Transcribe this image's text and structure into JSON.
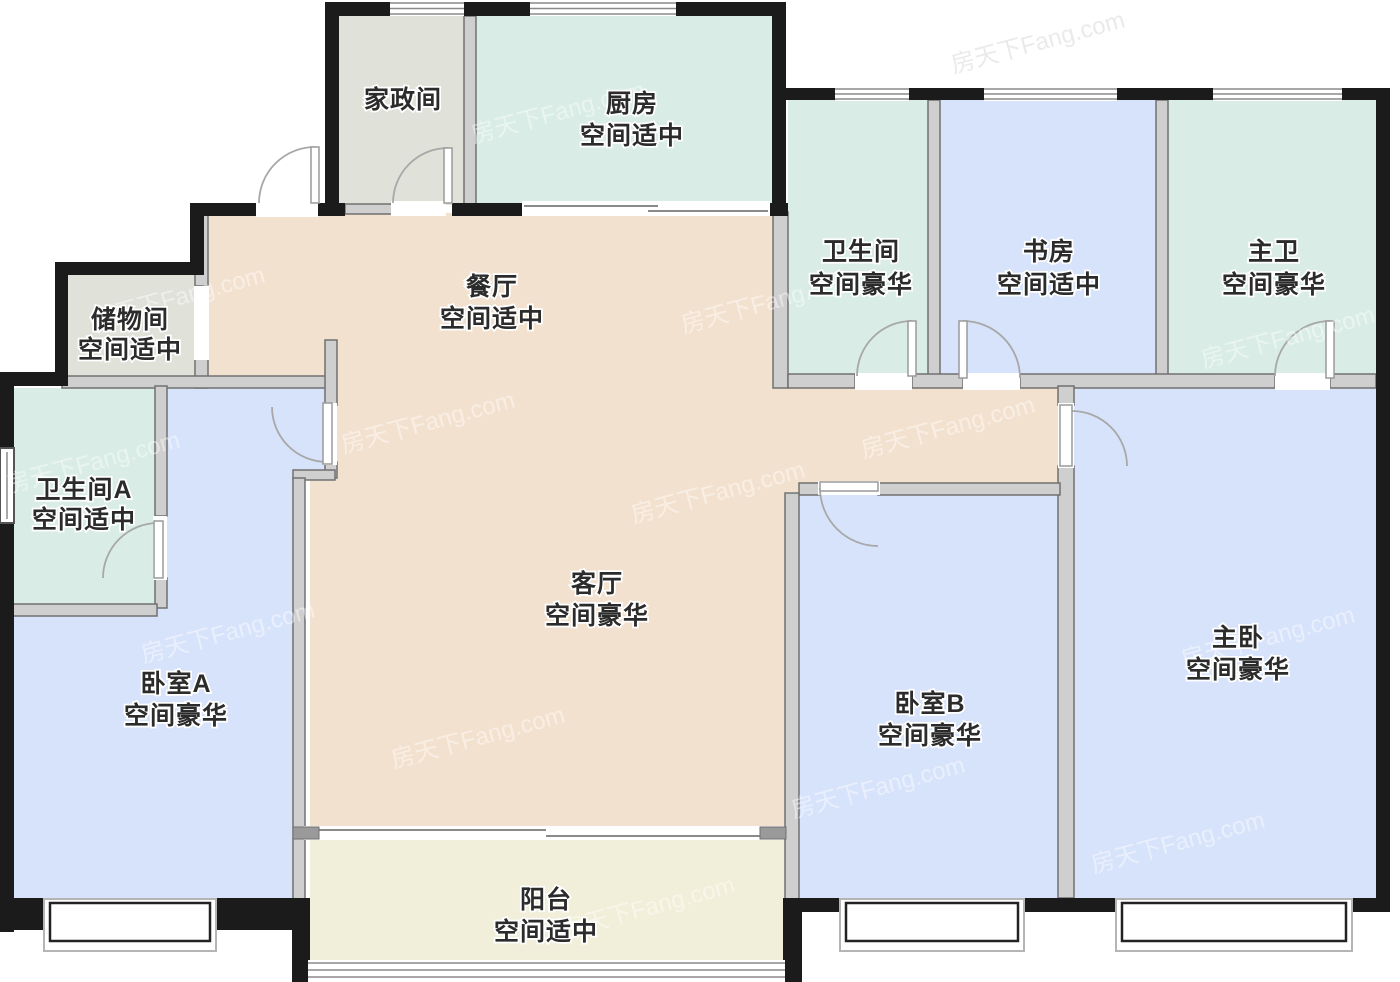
{
  "palette": {
    "room_dining": "#f3e1cf",
    "room_mint": "#d9ece6",
    "room_blue": "#d7e3fb",
    "room_gray": "#e0e1d9",
    "room_cream": "#f1efd9",
    "wall": "#1b1b1b",
    "inner_wall": "#cfcfcf",
    "label": "#2b2b2b"
  },
  "watermark": {
    "text": "房天下Fang.com"
  },
  "rooms": {
    "housekeeping": {
      "name": "家政间",
      "grade": ""
    },
    "kitchen": {
      "name": "厨房",
      "grade": "空间适中"
    },
    "bathroom": {
      "name": "卫生间",
      "grade": "空间豪华"
    },
    "study": {
      "name": "书房",
      "grade": "空间适中"
    },
    "master_bath": {
      "name": "主卫",
      "grade": "空间豪华"
    },
    "storage": {
      "name": "储物间",
      "grade": "空间适中"
    },
    "dining": {
      "name": "餐厅",
      "grade": "空间适中"
    },
    "bathroom_a": {
      "name": "卫生间A",
      "grade": "空间适中"
    },
    "living": {
      "name": "客厅",
      "grade": "空间豪华"
    },
    "bedroom_a": {
      "name": "卧室A",
      "grade": "空间豪华"
    },
    "bedroom_b": {
      "name": "卧室B",
      "grade": "空间豪华"
    },
    "master_bedroom": {
      "name": "主卧",
      "grade": "空间豪华"
    },
    "balcony": {
      "name": "阳台",
      "grade": "空间适中"
    }
  }
}
